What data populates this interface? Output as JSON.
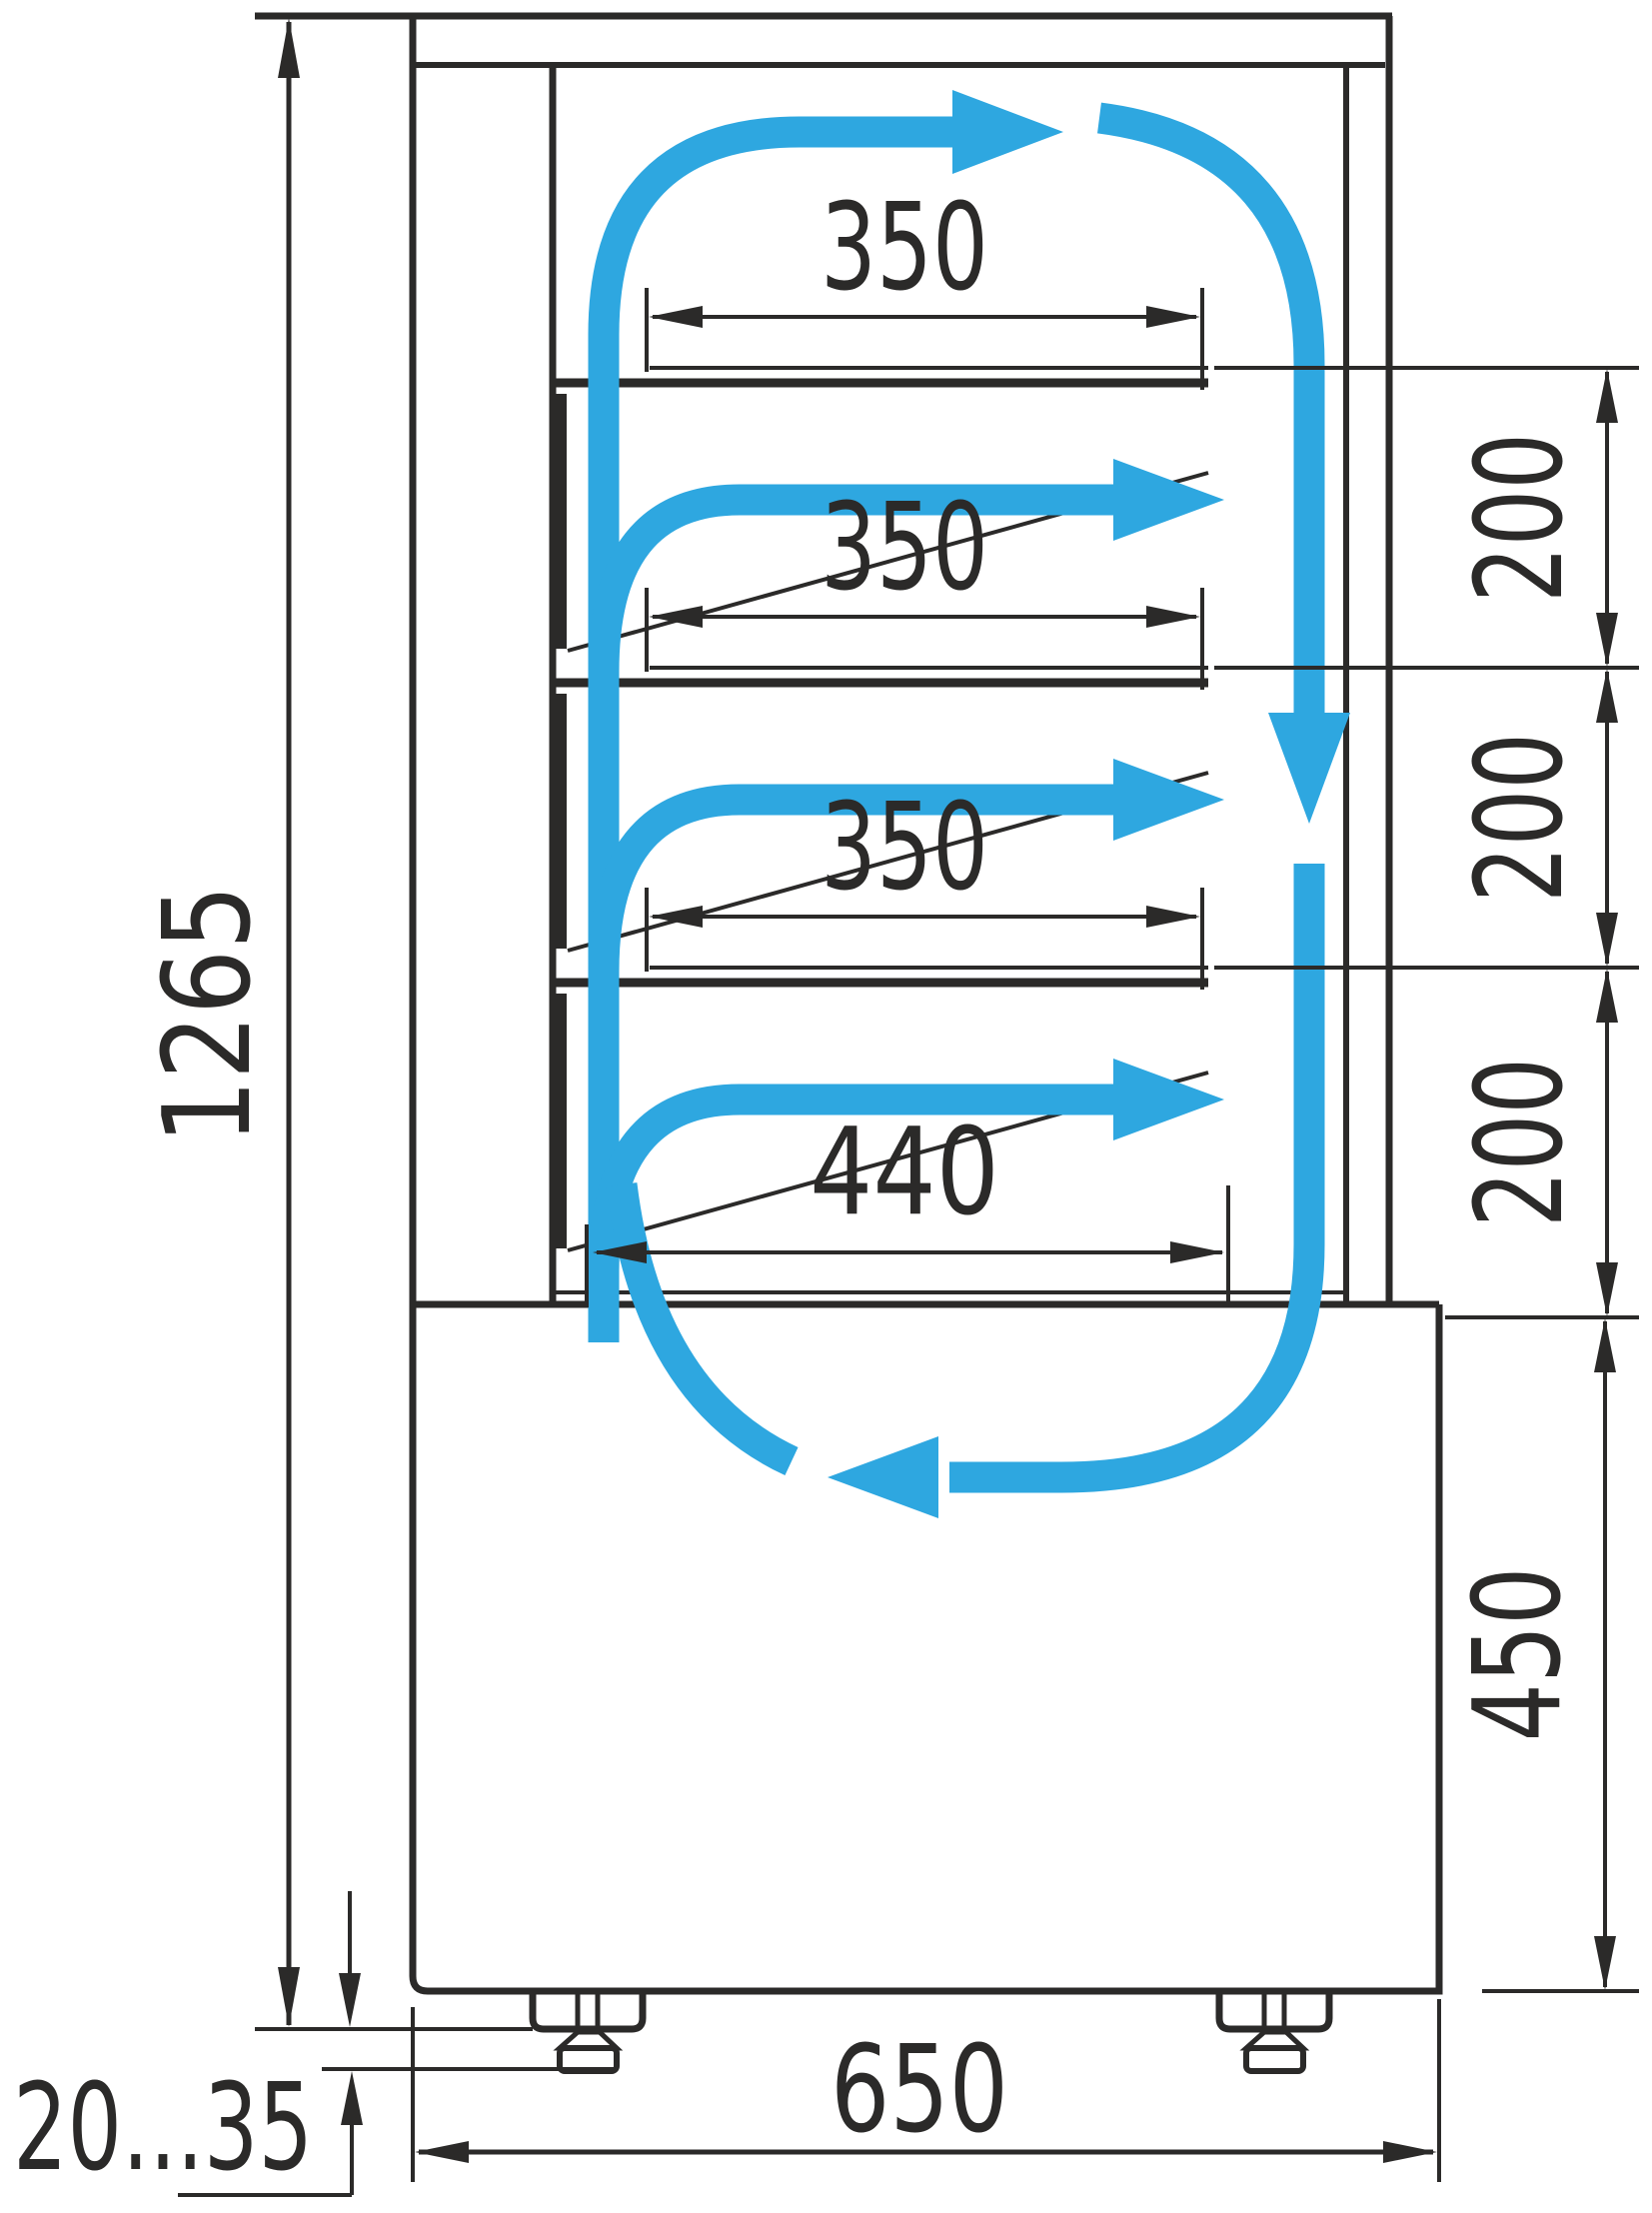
{
  "diagram": {
    "type": "technical-drawing",
    "subject": "refrigerated-display-case-side-section-with-airflow",
    "colors": {
      "line": "#2b2a29",
      "airflow": "#2ea7e0",
      "background": "#ffffff"
    },
    "labels": {
      "overall_height": "1265",
      "shelf1_depth": "350",
      "shelf2_depth": "350",
      "shelf3_depth": "350",
      "bottom_shelf_depth": "440",
      "gap1": "200",
      "gap2": "200",
      "gap3": "200",
      "base_height": "450",
      "base_depth": "650",
      "leg_adjustment_range": "20...35"
    }
  }
}
